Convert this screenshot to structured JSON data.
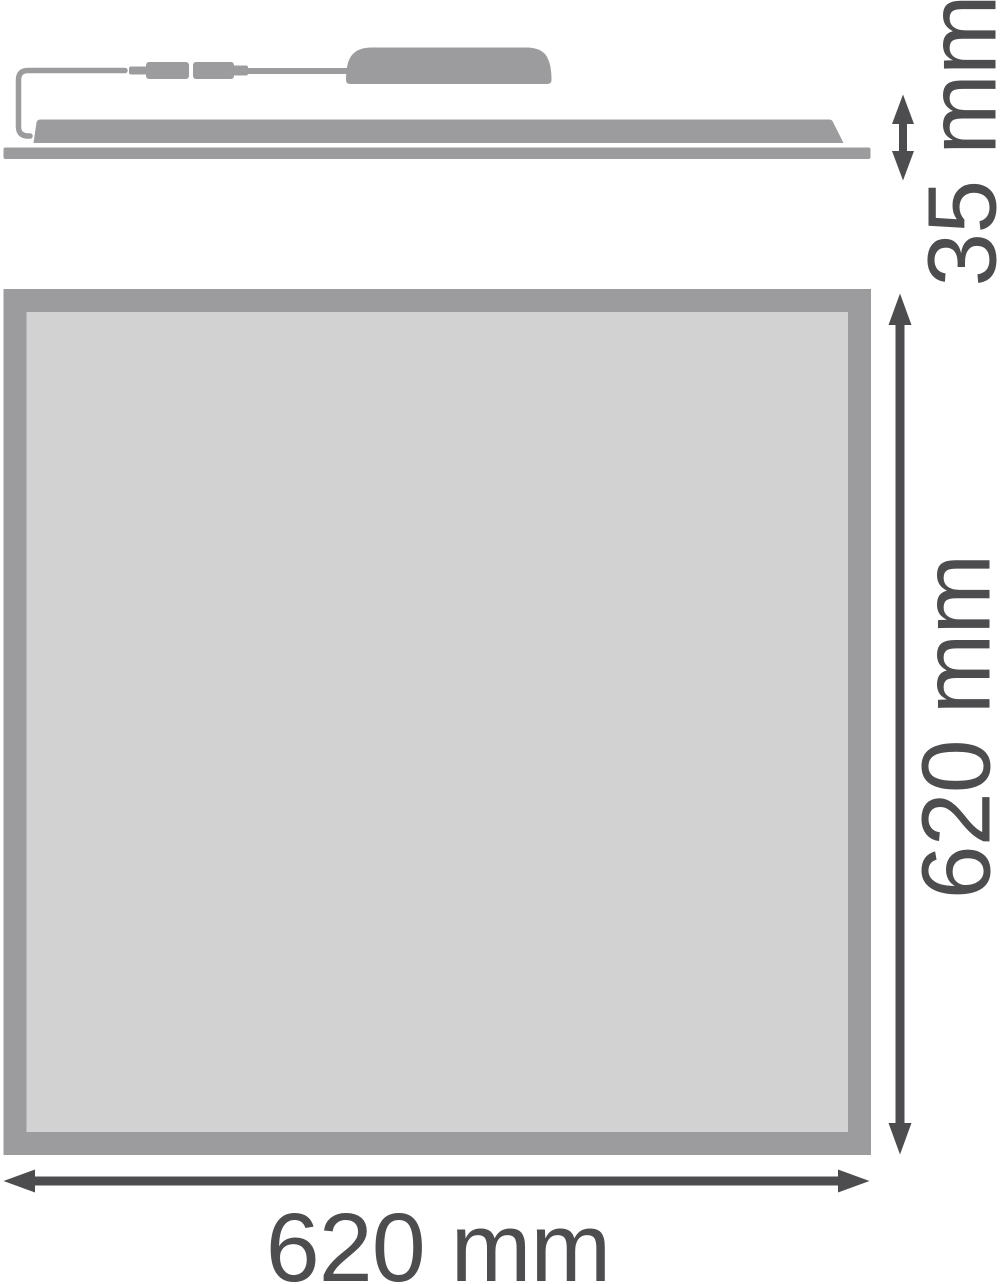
{
  "diagram": {
    "kind": "product-dimension-drawing",
    "views": [
      "side-profile",
      "front-face"
    ]
  },
  "labels": {
    "side_height": "35 mm",
    "front_height": "620 mm",
    "front_width": "620 mm"
  },
  "dimensions": {
    "depth_mm": 35,
    "height_mm": 620,
    "width_mm": 620,
    "unit": "mm"
  },
  "colors": {
    "product_gray": "#9c9c9e",
    "diffuser_gray": "#d2d2d3",
    "dimension_dark": "#4d4d4f",
    "background": "#ffffff"
  }
}
